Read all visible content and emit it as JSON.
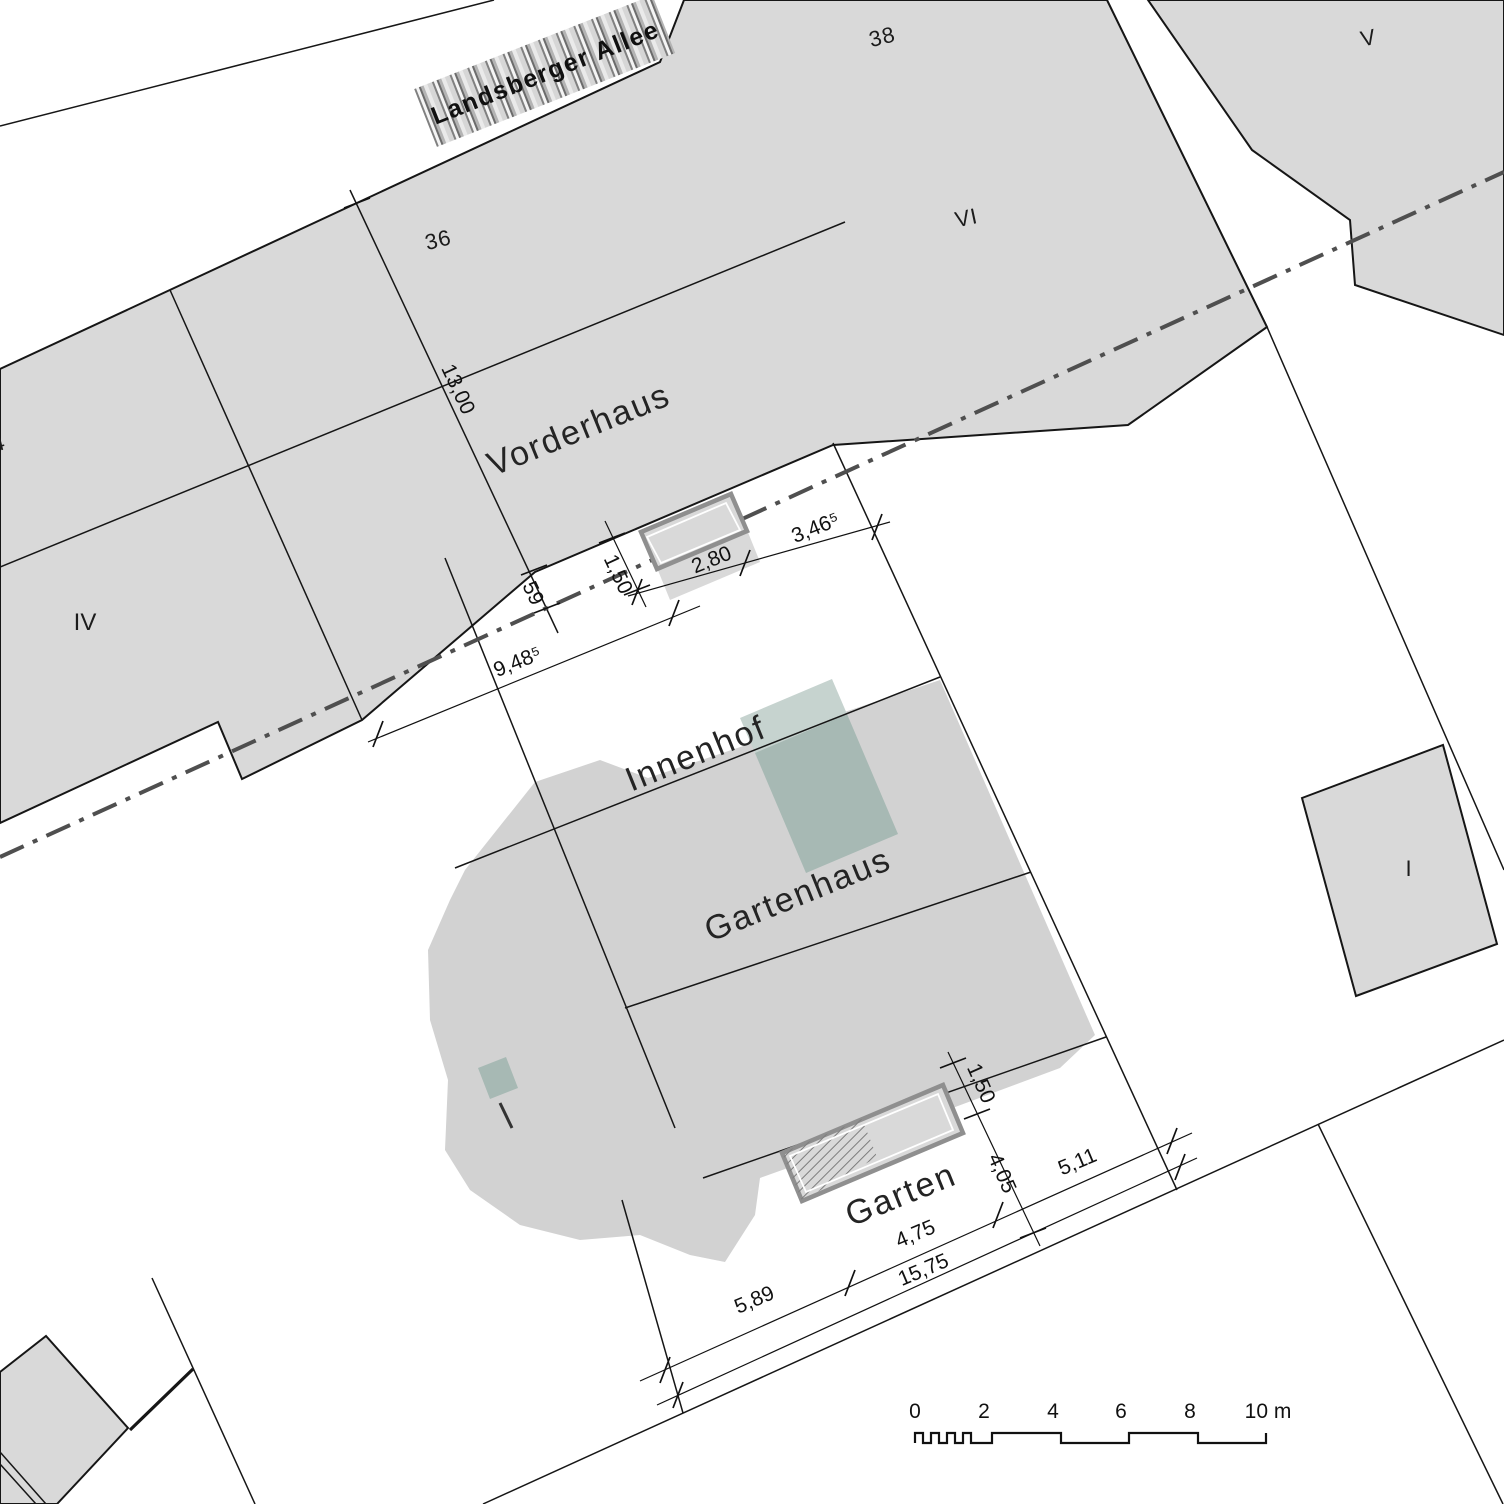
{
  "title": "Lageplan",
  "labels": {
    "street": "Landsberger Allee",
    "vorderhaus": "Vorderhaus",
    "innenhof": "Innenhof",
    "gartenhaus": "Gartenhaus",
    "garten": "Garten"
  },
  "parcels": {
    "p34": "34",
    "p36": "36",
    "p38": "38",
    "pI": "I",
    "pIV": "IV",
    "pV": "V",
    "pVI": "VI"
  },
  "dimensions": {
    "d13": "13,00",
    "d59": "59",
    "d150a": "1,50",
    "d280": "2,80",
    "d3465": "3,46⁵",
    "d9485": "9,48⁵",
    "d150b": "1,50",
    "d405": "4,05",
    "d511": "5,11",
    "d475": "4,75",
    "d1575": "15,75",
    "d589": "5,89"
  },
  "scale_bar": {
    "ticks": [
      "0",
      "2",
      "4",
      "6",
      "8"
    ],
    "end": "10 m"
  },
  "colors": {
    "parcel_fill": "#d9d9d9",
    "line": "#161616",
    "boundary_dashdot": "#4f4f4f",
    "highlight_dark": "#a7b9b4",
    "highlight_light": "#c6d3cf"
  }
}
